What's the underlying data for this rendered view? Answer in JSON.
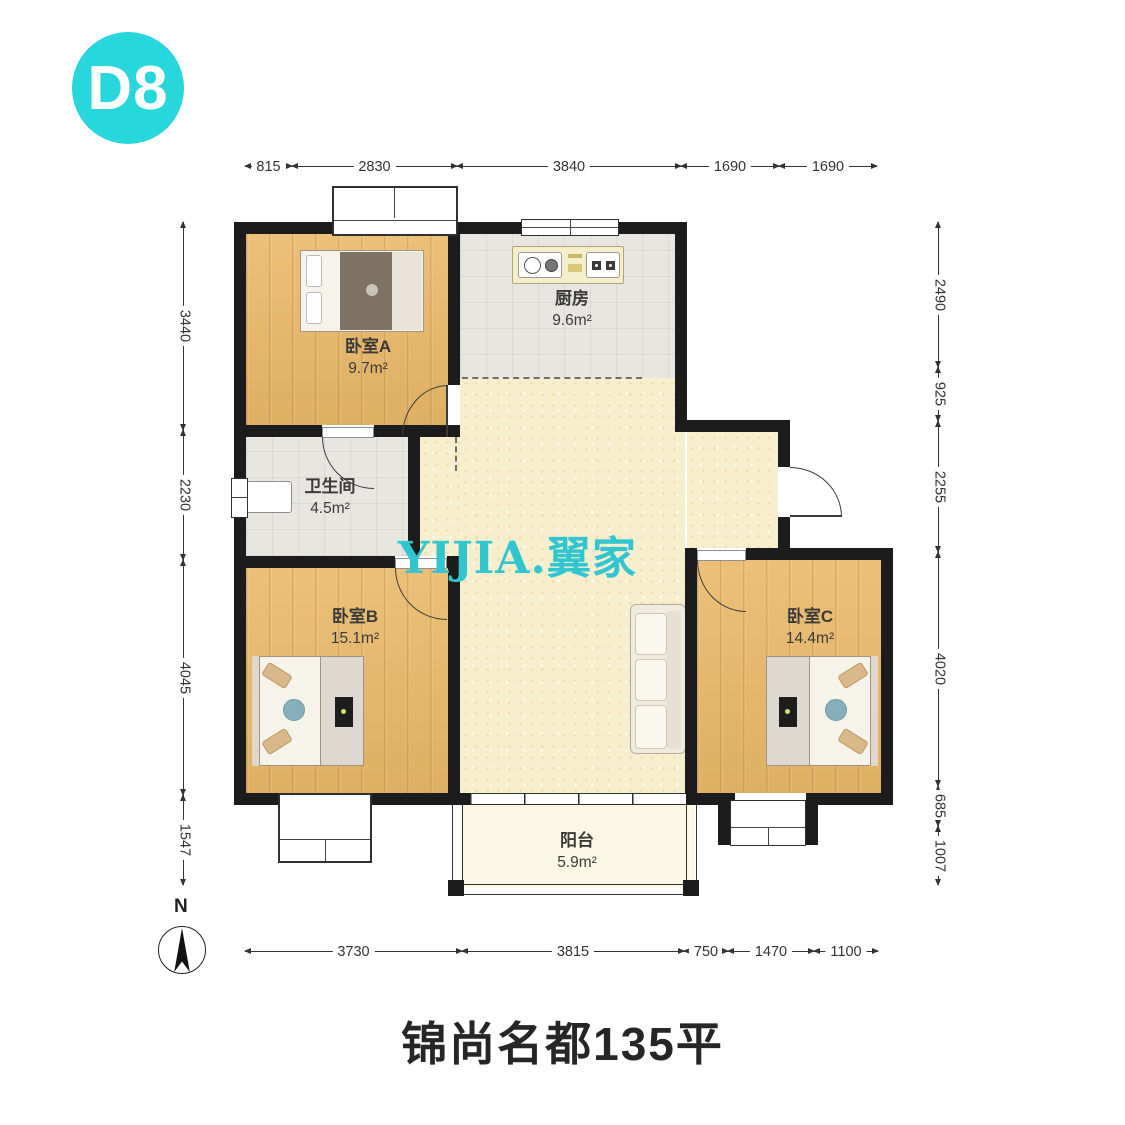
{
  "badge": "D8",
  "title": "锦尚名都135平",
  "watermark": "YIJIA.翼家",
  "compass": "N",
  "rooms": {
    "bedroomA": {
      "name": "卧室A",
      "area": "9.7m²"
    },
    "kitchen": {
      "name": "厨房",
      "area": "9.6m²"
    },
    "bathroom": {
      "name": "卫生间",
      "area": "4.5m²"
    },
    "bedroomB": {
      "name": "卧室B",
      "area": "15.1m²"
    },
    "bedroomC": {
      "name": "卧室C",
      "area": "14.4m²"
    },
    "balcony": {
      "name": "阳台",
      "area": "5.9m²"
    }
  },
  "dims": {
    "top": [
      "815",
      "2830",
      "3840",
      "1690",
      "1690"
    ],
    "left": [
      "3440",
      "2230",
      "4045",
      "1547"
    ],
    "right": [
      "2490",
      "925",
      "2255",
      "4020",
      "685",
      "1007"
    ],
    "bottom": [
      "3730",
      "3815",
      "750",
      "1470",
      "1100"
    ]
  },
  "colors": {
    "badge_cyan": "#28d7dc",
    "watermark_cyan": "#31c5d0",
    "wall_black": "#1c1c1c",
    "wood_floor": "#eab969",
    "tile_floor": "#e7e6e1",
    "living_floor": "#f7eecd",
    "balcony_floor": "#fbf8e6",
    "text": "#333333"
  }
}
